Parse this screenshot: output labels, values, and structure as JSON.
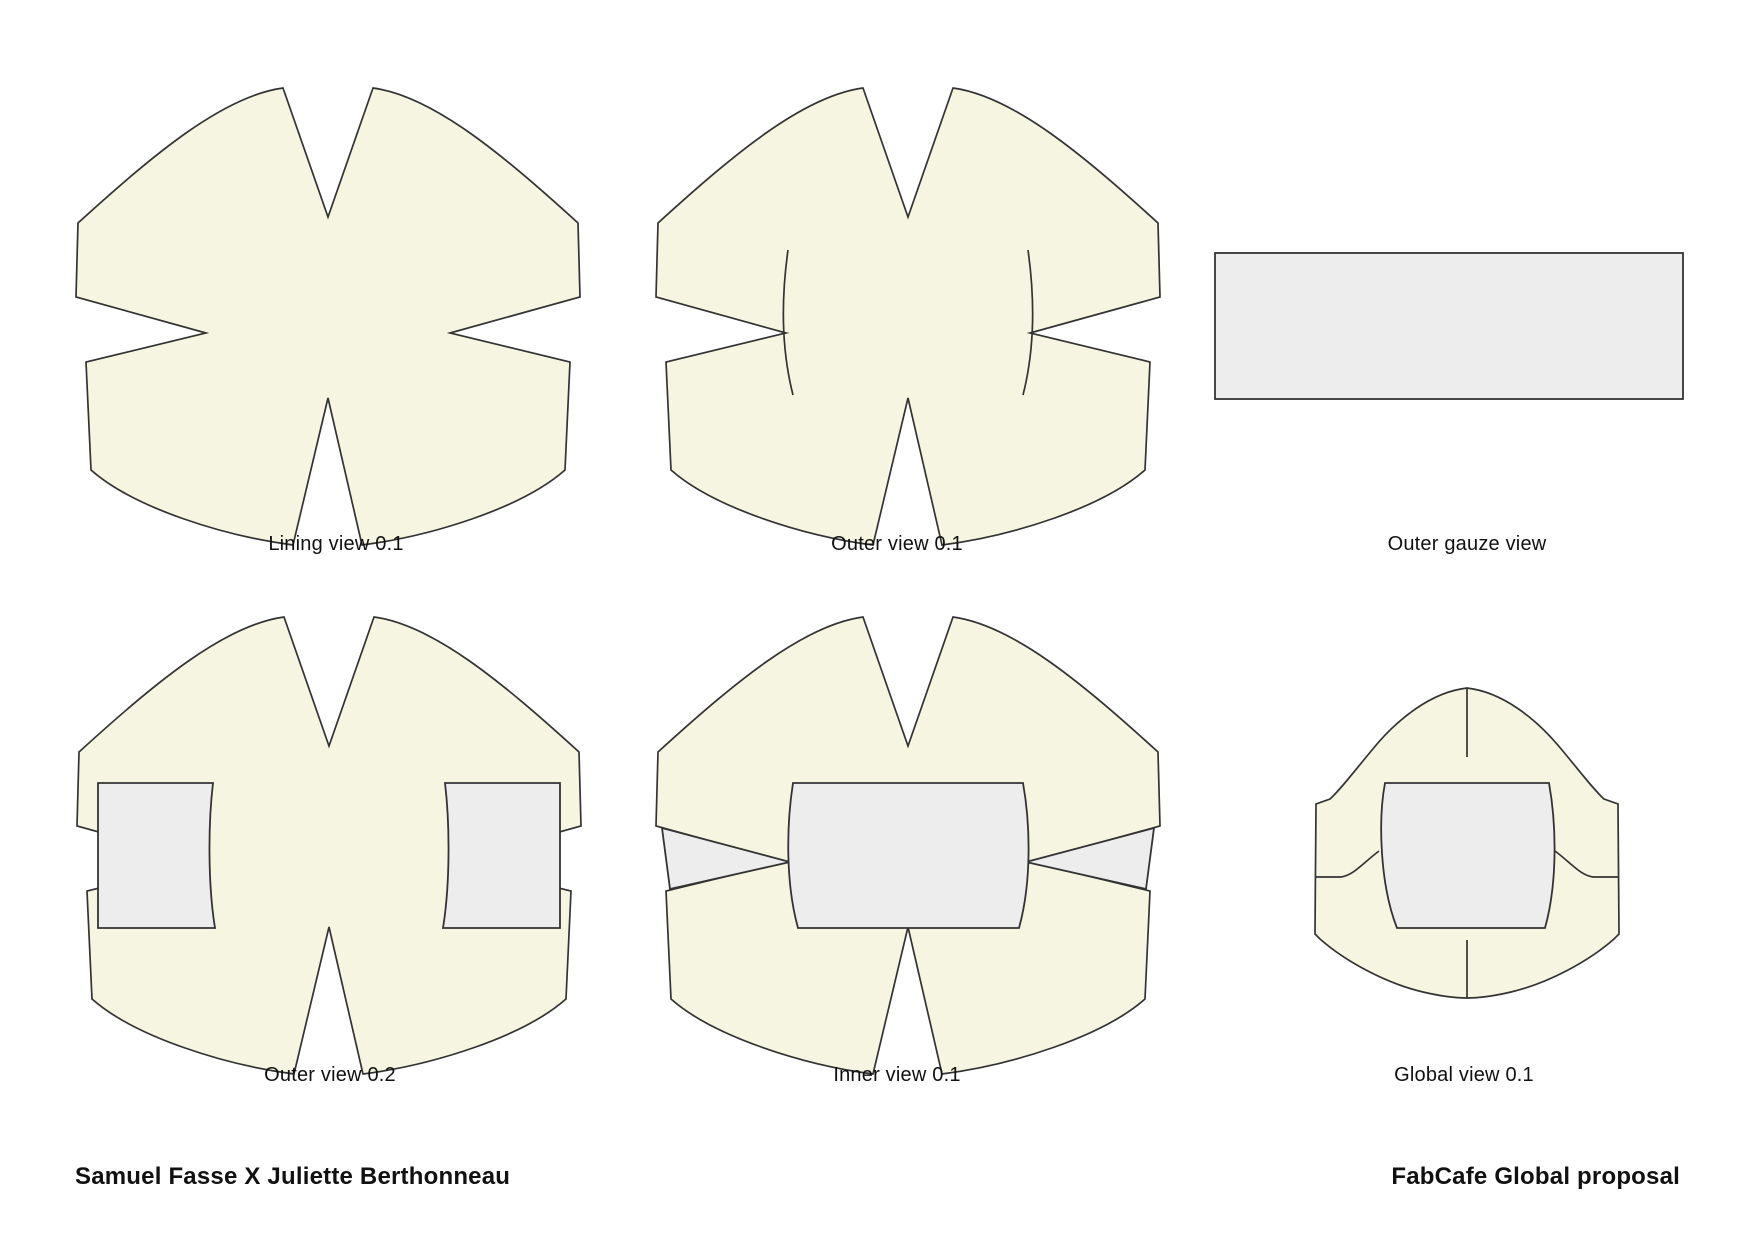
{
  "page": {
    "background": "#ffffff"
  },
  "colors": {
    "fabric_fill": "#f5f5e1",
    "gauze_fill": "#ededed",
    "outline": "#333333",
    "text": "#111111"
  },
  "figures": [
    {
      "id": "lining-view",
      "label": "Lining view 0.1"
    },
    {
      "id": "outer-view-01",
      "label": "Outer view 0.1"
    },
    {
      "id": "outer-gauze-view",
      "label": "Outer gauze view"
    },
    {
      "id": "outer-view-02",
      "label": "Outer view 0.2"
    },
    {
      "id": "inner-view",
      "label": "Inner view 0.1"
    },
    {
      "id": "global-view",
      "label": "Global view 0.1"
    }
  ],
  "footer": {
    "left": "Samuel Fasse X Juliette Berthonneau",
    "right": "FabCafe Global proposal"
  }
}
